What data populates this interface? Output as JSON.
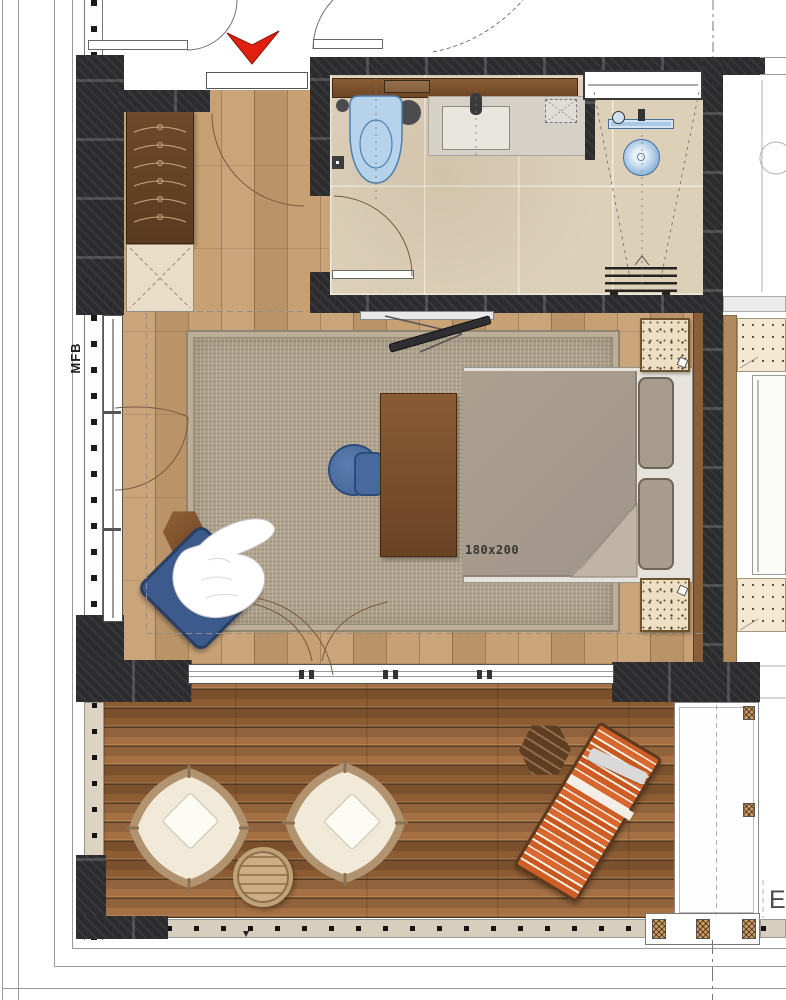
{
  "labels": {
    "wall_marker": "MFB",
    "bed_dimensions": "180x200",
    "edge_text_partial": "E"
  },
  "icons": {
    "entrance-arrow-icon": "red downward chevron marking unit entrance",
    "door-swing-icon": "quarter-circle door swing arcs",
    "hanger-icon": "clothes hangers inside wardrobe"
  },
  "colors": {
    "arrow_red": "#e0200f",
    "wall_dark": "#2c2b2d",
    "bedroom_wood": "#c59d6f",
    "deck_wood": "#9a6538",
    "bathroom_tile": "#ddd0b9",
    "rug_taupe": "#b1a48e",
    "fixture_blue": "#b7d3ec",
    "armchair_blue": "#3d5a8c",
    "lounger_orange": "#cf5d26",
    "duvet_gray": "#a89c8c"
  },
  "furniture": {
    "bedroom": [
      "wardrobe with hangers",
      "luggage bench",
      "area rug",
      "double bed 180x200",
      "two pillows",
      "two speckled nightstands",
      "wall TV on swing arm",
      "wood desk",
      "blue desk chair",
      "blue lounge armchair with white throw",
      "hexagonal side table"
    ],
    "bathroom": [
      "wall shelf",
      "toilet",
      "vanity with sink",
      "storage niche",
      "walk-in shower",
      "linear drain",
      "shower bench"
    ],
    "terrace": [
      "two wicker lounge chairs with cushions",
      "round slatted coffee table",
      "orange striped sun lounger",
      "dark hexagonal side table",
      "white planter divider",
      "railing"
    ]
  }
}
